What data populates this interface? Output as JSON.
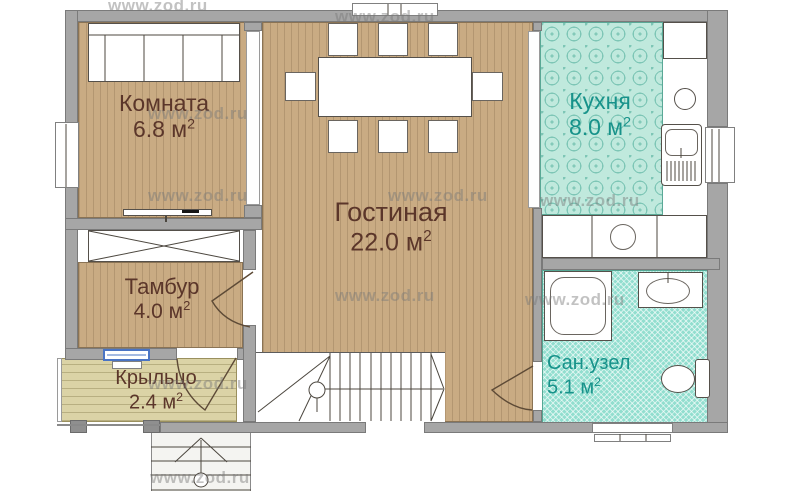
{
  "plan": {
    "watermark_text": "www.zod.ru",
    "rooms": [
      {
        "key": "komnata",
        "name": "Комната",
        "area_label": "6.8 м",
        "area_sup": "2"
      },
      {
        "key": "gostinaya",
        "name": "Гостиная",
        "area_label": "22.0 м",
        "area_sup": "2"
      },
      {
        "key": "kuhnya",
        "name": "Кухня",
        "area_label": "8.0 м",
        "area_sup": "2"
      },
      {
        "key": "tambur",
        "name": "Тамбур",
        "area_label": "4.0 м",
        "area_sup": "2"
      },
      {
        "key": "kryltso",
        "name": "Крыльцо",
        "area_label": "2.4 м",
        "area_sup": "2"
      },
      {
        "key": "sanuzel",
        "name": "Сан.узел",
        "area_label": "5.1 м",
        "area_sup": "2"
      }
    ],
    "colors": {
      "wood_floor": "#c9ab83",
      "kitchen_tile": "#c0e9dd",
      "bath_tile": "#92decf",
      "porch_floor": "#dbd3a6",
      "wall_gray": "#a6a6a6",
      "label_brown": "#5b362a",
      "label_teal": "#17928a",
      "window_blue": "#4a74c4"
    }
  }
}
